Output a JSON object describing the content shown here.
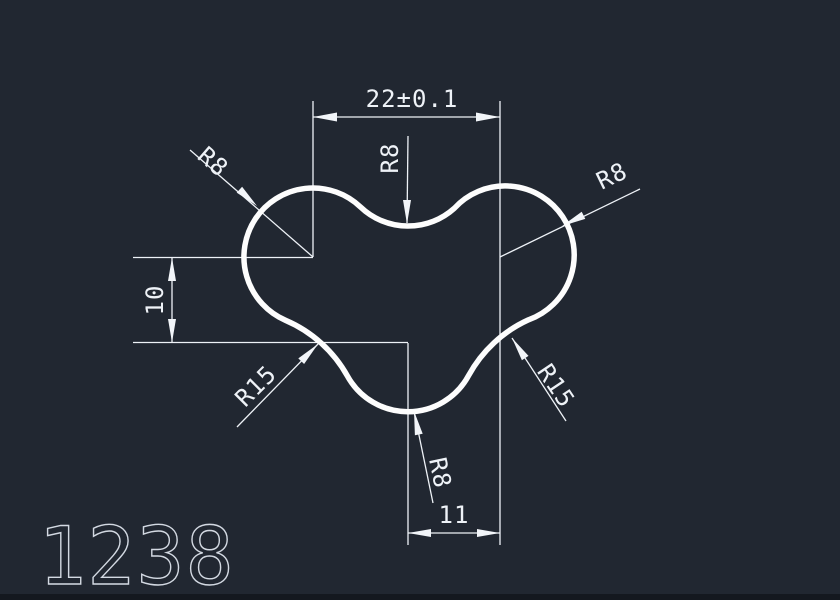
{
  "drawing": {
    "part_number": "1238",
    "dims": {
      "top_width": "22±0.1",
      "left_height": "10",
      "bottom_width": "11",
      "radius_top_left": "R8",
      "radius_top_center": "R8",
      "radius_top_right": "R8",
      "radius_bottom_left": "R15",
      "radius_bottom_right": "R15",
      "radius_bottom_center": "R8"
    },
    "colors": {
      "background": "#212731",
      "dimension_lines": "#eef2f7",
      "profile_outline": "#fdfdfd",
      "part_number_text": "#d3d9e2",
      "bottom_band": "#14181f"
    }
  }
}
